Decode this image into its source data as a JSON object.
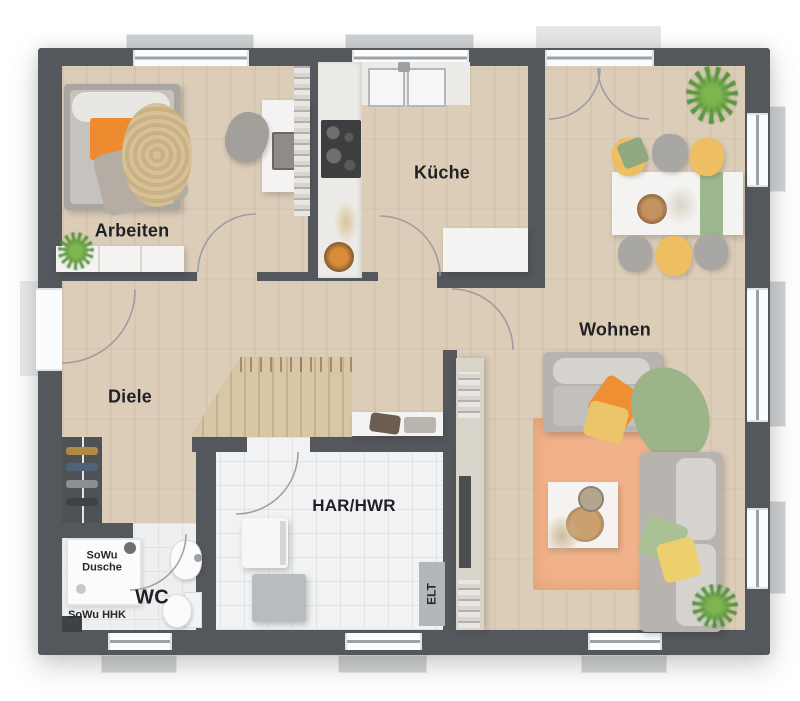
{
  "plan_title": "Erdgeschoss Grundriss",
  "rooms": [
    {
      "name": "Arbeiten"
    },
    {
      "name": "Küche"
    },
    {
      "name": "Wohnen"
    },
    {
      "name": "Diele"
    },
    {
      "name": "HAR/HWR"
    },
    {
      "name": "WC"
    }
  ],
  "annotations": {
    "shower_line1": "SoWu",
    "shower_line2": "Dusche",
    "heater": "SoWu HHK",
    "electrical": "ELT"
  },
  "colors": {
    "wall": "#54575b",
    "wood_floor": "#dccdb9",
    "tile_floor": "#edeff1",
    "accent_orange": "#ee8a2f",
    "accent_yellow": "#edbe62",
    "accent_green": "#9cb488",
    "rug_peach": "#f1b28a"
  }
}
